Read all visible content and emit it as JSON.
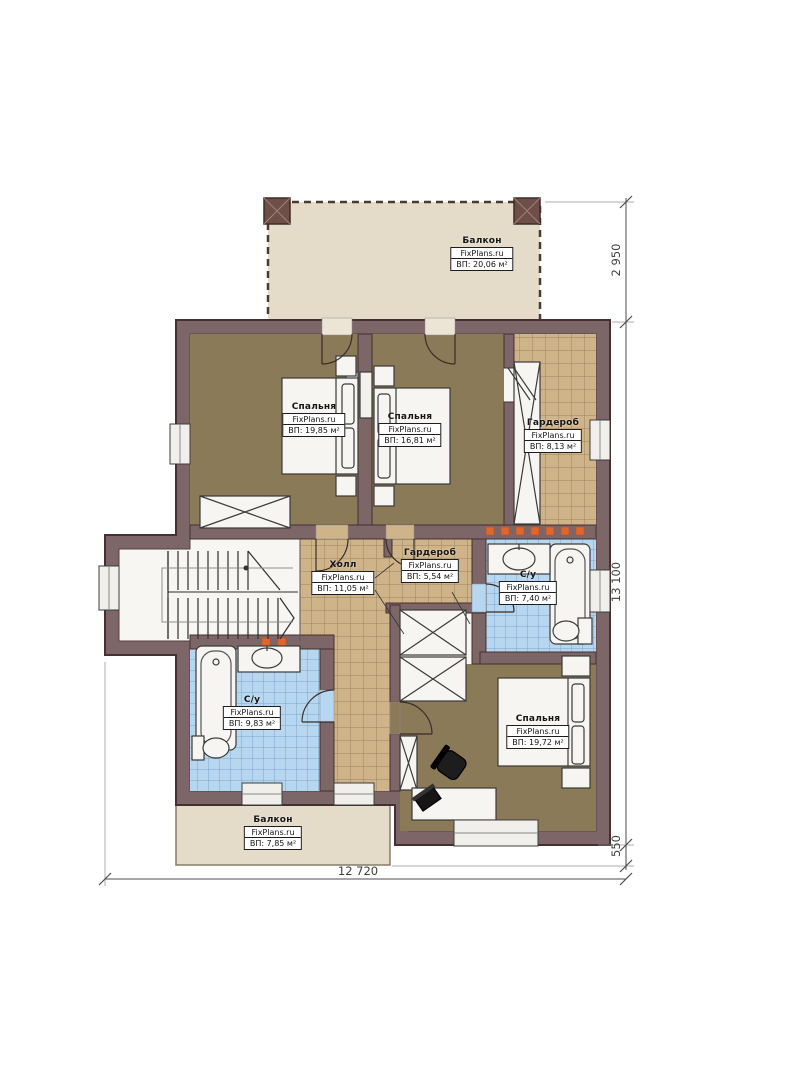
{
  "brand": "FixPlans.ru",
  "rooms": [
    {
      "id": "balcony-top",
      "name": "Балкон",
      "area": "ВП: 20,06 м²"
    },
    {
      "id": "bedroom-top-left",
      "name": "Спальня",
      "area": "ВП: 19,85 м²"
    },
    {
      "id": "bedroom-top-mid",
      "name": "Спальня",
      "area": "ВП: 16,81 м²"
    },
    {
      "id": "wardrobe-right",
      "name": "Гардероб",
      "area": "ВП: 8,13 м²"
    },
    {
      "id": "hall",
      "name": "Холл",
      "area": "ВП: 11,05 м²"
    },
    {
      "id": "wardrobe-mid",
      "name": "Гардероб",
      "area": "ВП: 5,54 м²"
    },
    {
      "id": "bathroom-right",
      "name": "С/у",
      "area": "ВП: 7,40 м²"
    },
    {
      "id": "bathroom-left",
      "name": "С/у",
      "area": "ВП: 9,83 м²"
    },
    {
      "id": "bedroom-bottom",
      "name": "Спальня",
      "area": "ВП: 19,72 м²"
    },
    {
      "id": "balcony-bottom",
      "name": "Балкон",
      "area": "ВП: 7,85 м²"
    }
  ],
  "dimensions": {
    "balcony_depth": "2 950",
    "building_height": "13 100",
    "balcony_offset": "550",
    "building_width": "12 720"
  },
  "colors": {
    "wall": "#7d6668",
    "wall_outline": "#452f31",
    "floor_wood": "#8b7a57",
    "tile_tan": "#cfb489",
    "tile_blue": "#b7d7f0",
    "balcony": "#e4dcc9",
    "accent_orange": "#e0662c"
  }
}
